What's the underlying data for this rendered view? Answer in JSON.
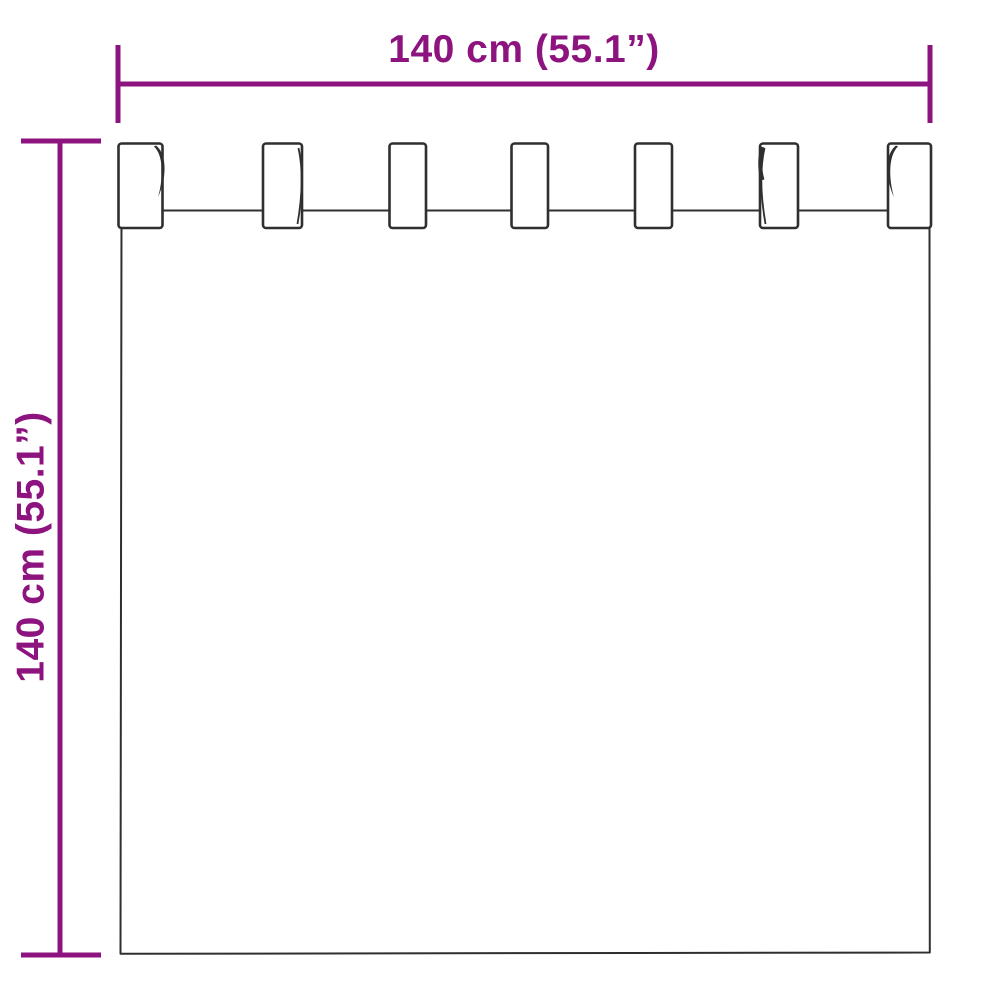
{
  "diagram": {
    "accent_color": "#8D147F",
    "outline_color": "#2F2F2F",
    "tab_count": 7,
    "width_dimension": {
      "label": "140 cm (55.1”)"
    },
    "height_dimension": {
      "label": "140 cm (55.1”)"
    }
  }
}
